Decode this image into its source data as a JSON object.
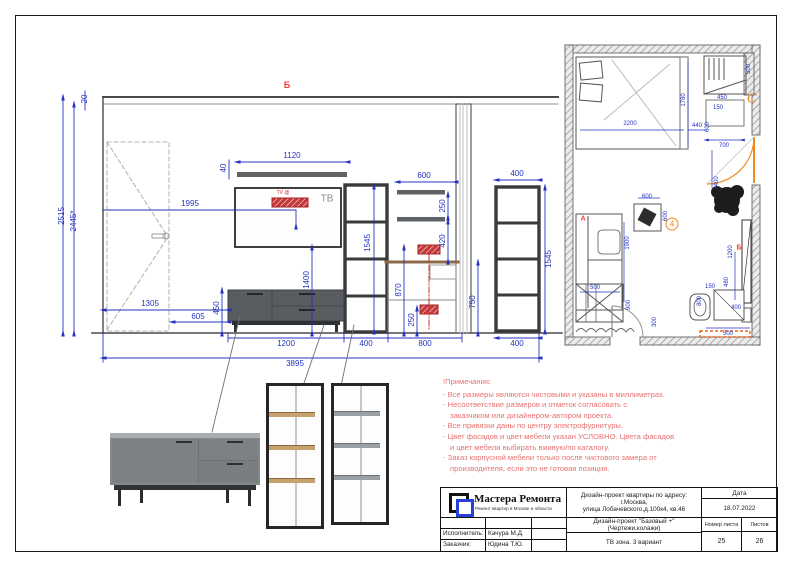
{
  "colors": {
    "dim": "#2433c0",
    "note": "#e87272",
    "marker_red": "#ff3b30",
    "orange": "#f08a1e"
  },
  "elevation": {
    "view_marker": "Б",
    "tv_label": "ТВ",
    "tv_outlet_label": "TV @",
    "dims": {
      "ceiling_gap": "20",
      "height_total": "2515",
      "height_clear": "2445*",
      "tv_center_offset": "1995",
      "top_shelf_width": "1120",
      "top_shelf_thickness": "40",
      "tv_zone_height": "1400",
      "tower_left_height": "1545",
      "tower_left_width": "400",
      "desk_shelf_width": "600",
      "desk_shelf_gap": "250",
      "desk_shelf_offset": "420",
      "outlet_height": "870",
      "outlet_low_height": "250",
      "desk_height": "750",
      "stand_wall_offset": "1305",
      "door_to_stand": "605",
      "stand_height": "450",
      "stand_width": "1200",
      "desk_width": "800",
      "tower_right_width_top": "400",
      "tower_right_width_bottom": "400",
      "tower_right_height": "1545",
      "total_width": "3895"
    }
  },
  "plan": {
    "marker_a": "А",
    "marker_b": "Б",
    "marker_c": "С",
    "callout_4": "4",
    "dims": {
      "bed_width": "2200",
      "bed_length": "1780",
      "bed_gap": "440",
      "wardrobe_depth": "500",
      "wardrobe_width": "450",
      "niche_gap": "150",
      "column_width": "600",
      "door_offset": "700",
      "door_width": "1400",
      "table_width": "600",
      "table_depth": "600",
      "sofa_length": "1900",
      "sofa_width": "500",
      "wardrobe2_width": "900",
      "entry_clearance": "300",
      "tv_wall_width": "1200",
      "tv_shelf_width": "400",
      "tv_gap": "480",
      "desk_gap": "150",
      "desk_width": "800",
      "radiator_width": "500"
    }
  },
  "notes": {
    "title": "!Примечания:",
    "lines": [
      "- Все размеры являются чистовыми и указаны в миллиметрах.",
      "- Несоответствие размеров и отметок согласовать с",
      "заказчиком или дизайнером-автором проекта.",
      "- Все привязки даны по центру электрофурнитуры.",
      "- Цвет фасадов и цвет мебели указан УСЛОВНО. Цвета фасадов",
      "и цвет мебели выбирать вживую/по каталогу.",
      "- Заказ корпусной мебели только после чистового замера от",
      "производителя, если это не готовая позиция."
    ]
  },
  "titleblock": {
    "logo_title": "Мастера Ремонта",
    "logo_subtitle": "Ремонт квартир в Москве и области",
    "project_line1": "Дизайн-проект  квартиры по адресу: г.Москва,",
    "project_line2": "улица Лобачевского,д.100к4, кв.46",
    "project_type": "Дизайн-проект \"Базовый +\" (Чертежи,колажи)",
    "sheet_title": "ТВ зона. 3 вариант",
    "date_label": "Дата",
    "date_value": "18.07.2022",
    "sheet_num_label": "Номер листа",
    "sheets_label": "Листов",
    "sheet_num": "25",
    "sheets_total": "26",
    "executor_label": "Исполнитель:",
    "executor": "Качура М.Д.",
    "client_label": "Заказчик:",
    "client": "Юдина Т.Ю."
  }
}
